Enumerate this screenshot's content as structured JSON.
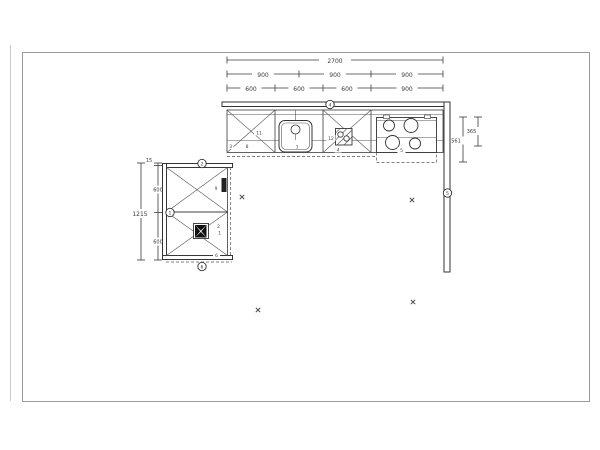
{
  "dimensions": {
    "top_total": "2700",
    "top_row2": [
      "900",
      "900",
      "900"
    ],
    "top_row3": [
      "600",
      "600",
      "600",
      "900"
    ],
    "left_total": "1215",
    "left_segments": [
      "15",
      "600",
      "600"
    ],
    "right_outer": "561",
    "right_inner": "365"
  },
  "item_labels": {
    "cab1_top": "11",
    "cab1_bottom": "8",
    "cab1_edge": "3",
    "sink_cabinet": "7",
    "hob_left": "12",
    "hob_below": "4",
    "cooktop": "5",
    "left_top_cabinet": "9",
    "fan_upper": "2",
    "fan_lower": "1",
    "left_bottom_corner": "6"
  },
  "position_markers": {
    "top_wall": "4",
    "left_wing_top": "2",
    "left_wall": "1",
    "right_wall": "5",
    "left_wing_bottom": "6"
  },
  "colors": {
    "line": "#3a3a3a",
    "frame_border": "#9b9b9b",
    "background": "#ffffff",
    "appliance_fill": "#222222"
  }
}
